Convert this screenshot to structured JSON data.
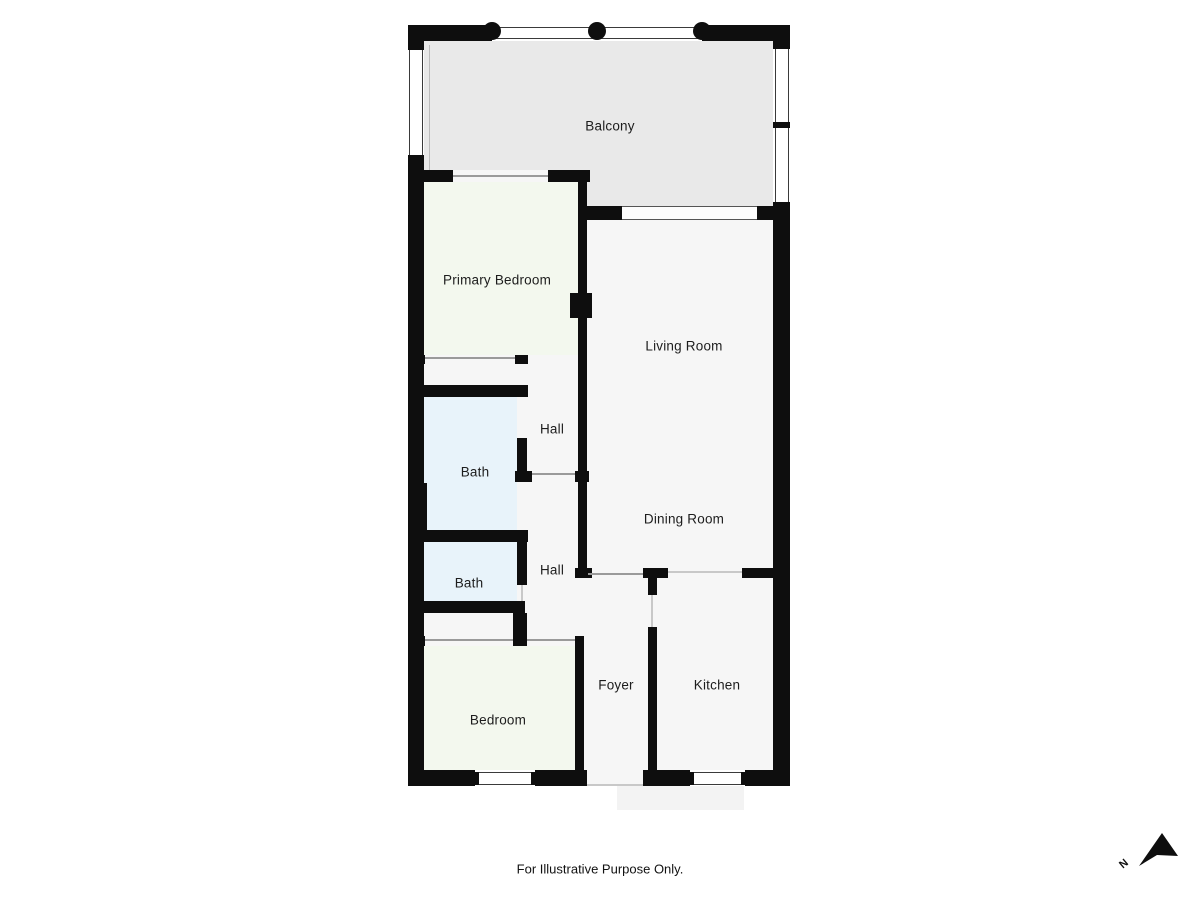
{
  "page": {
    "disclaimer": "For Illustrative Purpose Only.",
    "compass_label": "N"
  },
  "colors": {
    "wall": "#0e0e0e",
    "room_floor": "#f6f6f6",
    "balcony_floor": "#e9e9e9",
    "bedroom_floor": "#f3f8ee",
    "bath_floor": "#e8f3fa",
    "landing_floor": "#f3f3f3",
    "threshold": "#9a9a9a",
    "threshold_light": "#c8c8c8"
  },
  "rooms": [
    {
      "id": "balcony",
      "label": "Balcony"
    },
    {
      "id": "primary-bedroom",
      "label": "Primary Bedroom"
    },
    {
      "id": "living-room",
      "label": "Living Room"
    },
    {
      "id": "hall-upper",
      "label": "Hall"
    },
    {
      "id": "bath-upper",
      "label": "Bath"
    },
    {
      "id": "dining-room",
      "label": "Dining Room"
    },
    {
      "id": "hall-lower",
      "label": "Hall"
    },
    {
      "id": "bath-lower",
      "label": "Bath"
    },
    {
      "id": "bedroom",
      "label": "Bedroom"
    },
    {
      "id": "foyer",
      "label": "Foyer"
    },
    {
      "id": "kitchen",
      "label": "Kitchen"
    }
  ]
}
